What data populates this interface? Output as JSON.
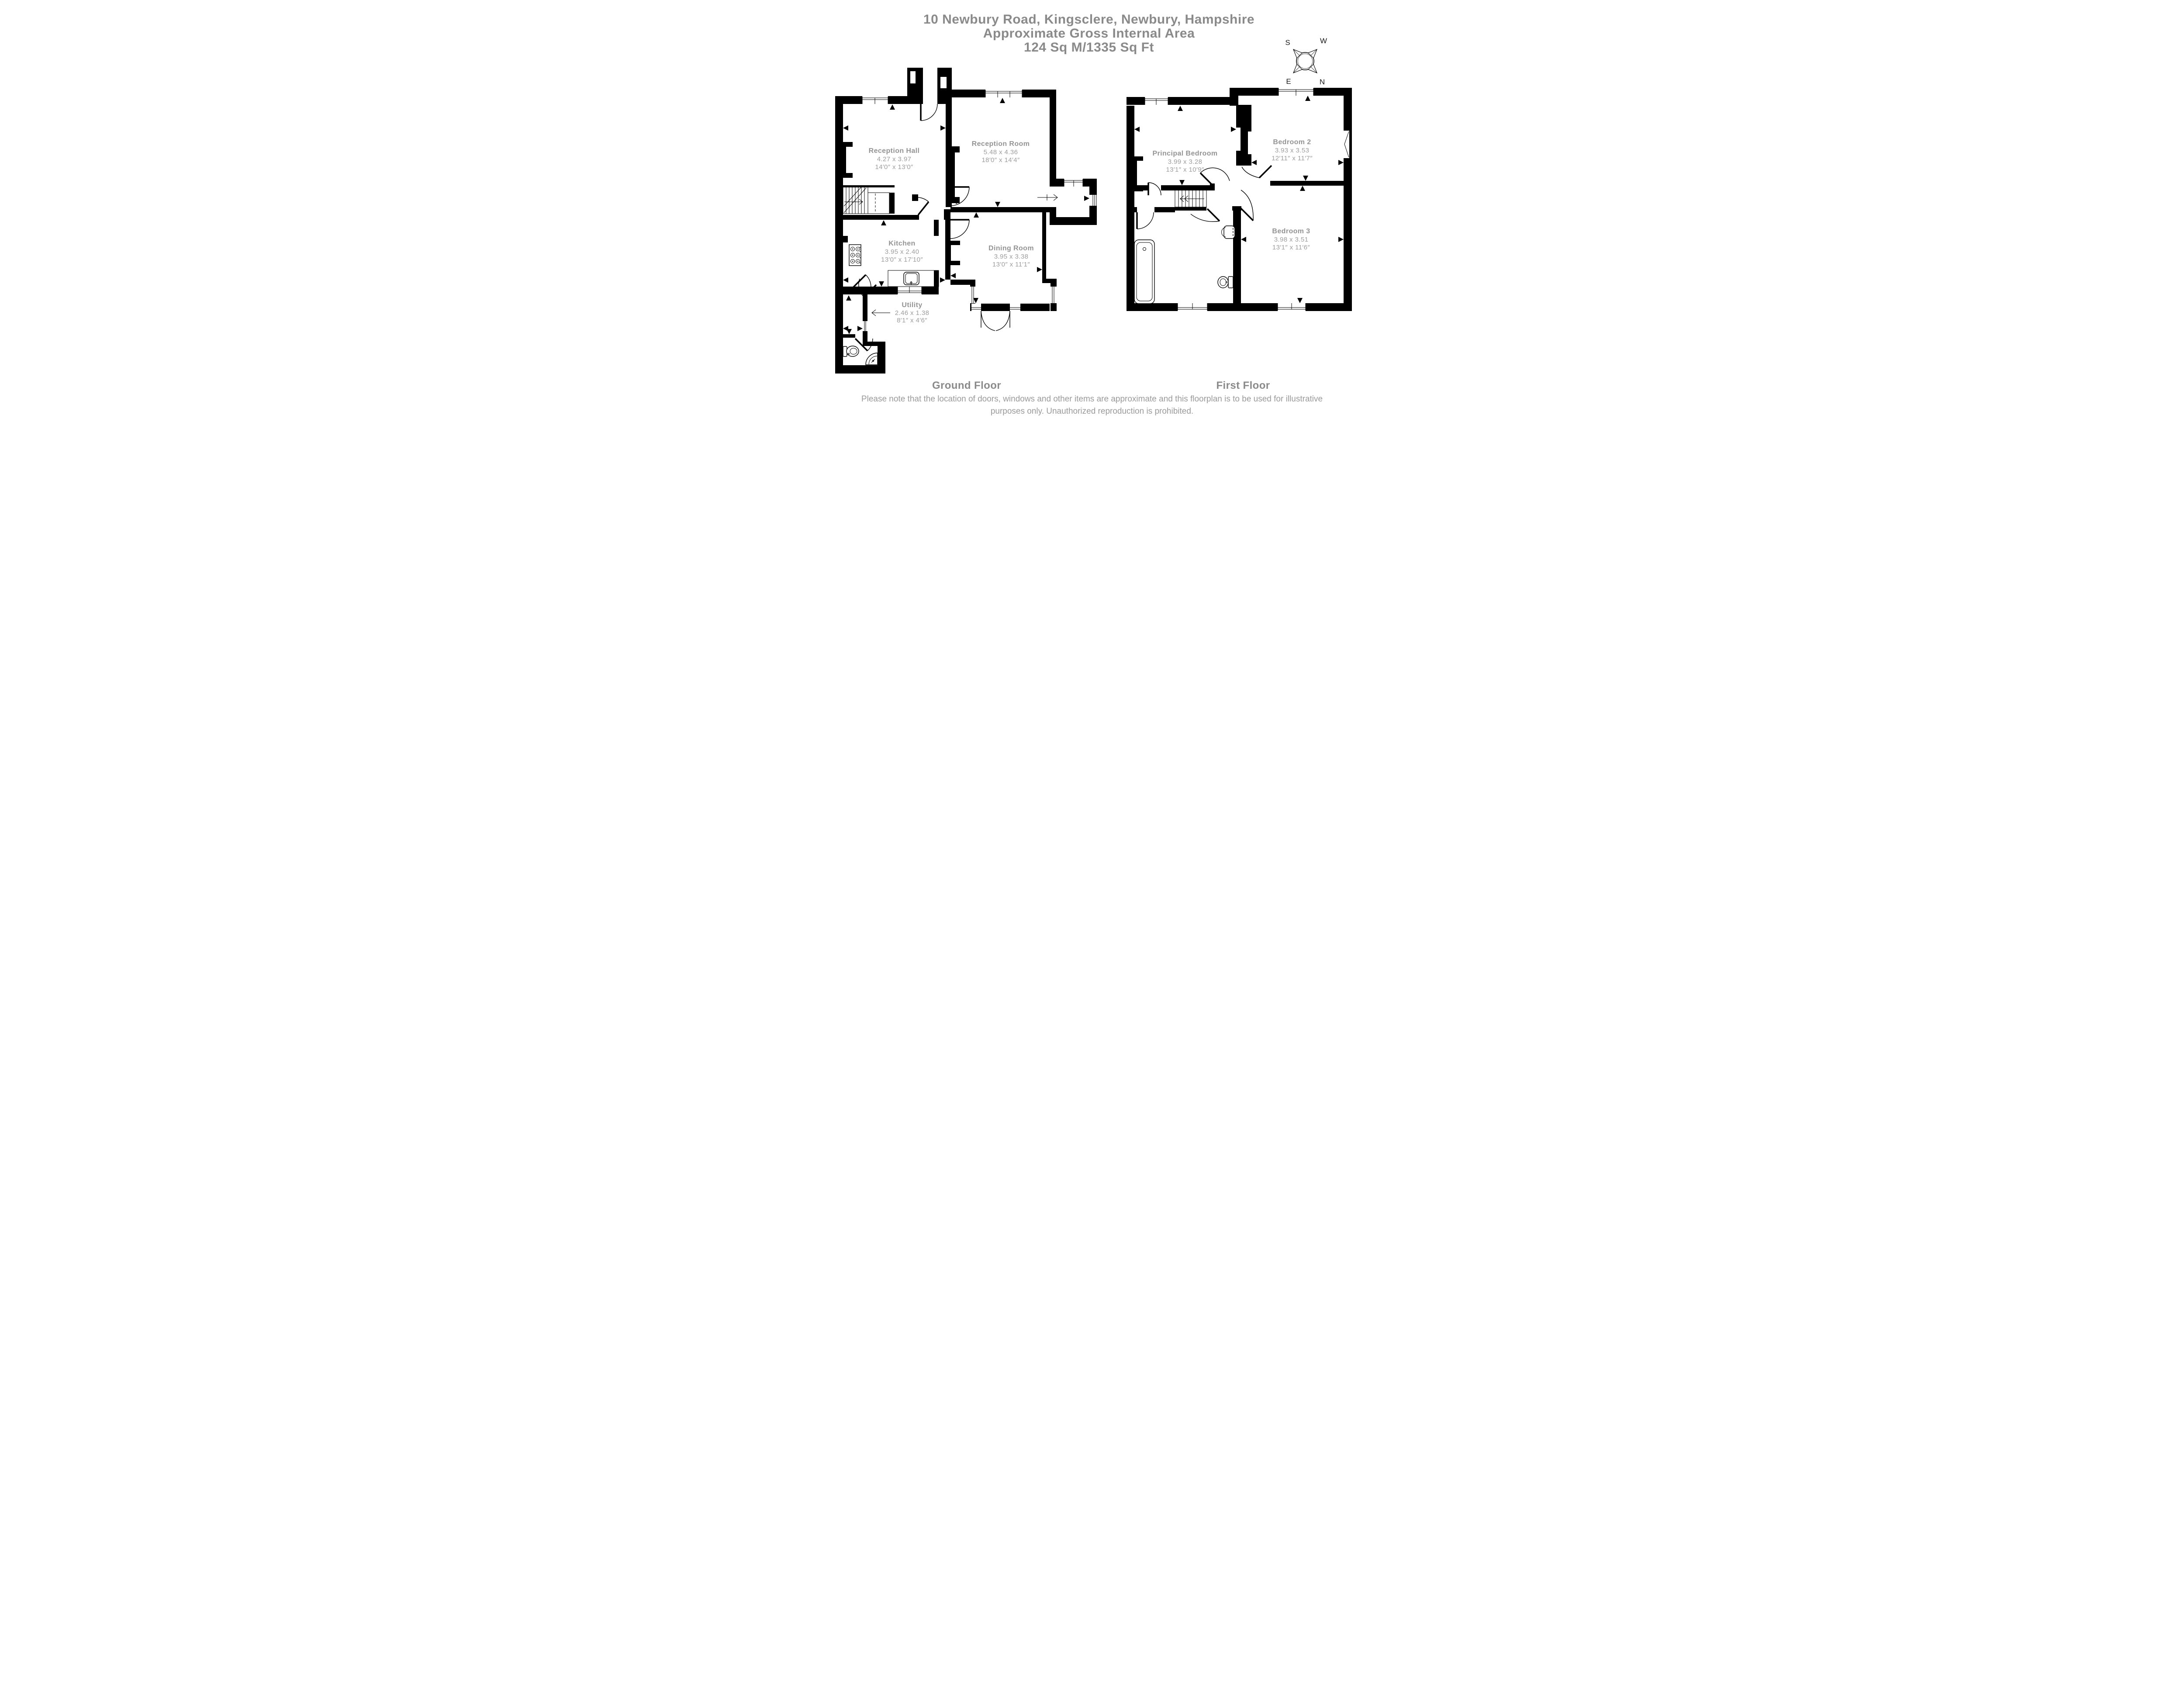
{
  "title": {
    "line1": "10 Newbury Road, Kingsclere, Newbury, Hampshire",
    "line2": "Approximate Gross Internal Area",
    "line3": "124 Sq M/1335 Sq Ft"
  },
  "compass": {
    "south": "S",
    "west": "W",
    "east": "E",
    "north": "N"
  },
  "ground_floor": {
    "label": "Ground Floor",
    "rooms": [
      {
        "name": "Reception Hall",
        "metric": "4.27 x 3.97",
        "imperial": "14′0″ x 13′0″"
      },
      {
        "name": "Reception Room",
        "metric": "5.48 x 4.36",
        "imperial": "18′0″ x 14′4″"
      },
      {
        "name": "Kitchen",
        "metric": "3.95 x 2.40",
        "imperial": "13′0″ x 17′10″"
      },
      {
        "name": "Dining Room",
        "metric": "3.95 x 3.38",
        "imperial": "13′0″ x 11′1″"
      },
      {
        "name": "Utility",
        "metric": "2.46 x 1.38",
        "imperial": "8′1″ x 4′6″"
      }
    ]
  },
  "first_floor": {
    "label": "First Floor",
    "rooms": [
      {
        "name": "Principal Bedroom",
        "metric": "3.99 x 3.28",
        "imperial": "13′1″ x 10′9″"
      },
      {
        "name": "Bedroom 2",
        "metric": "3.93 x 3.53",
        "imperial": "12′11″ x 11′7″"
      },
      {
        "name": "Bedroom 3",
        "metric": "3.98 x 3.51",
        "imperial": "13′1″ x 11′6″"
      }
    ]
  },
  "disclaimer": {
    "line1": "Please note that the location of doors, windows and other items are approximate and this floorplan is to be used for illustrative",
    "line2": "purposes only. Unauthorized reproduction is prohibited."
  },
  "colors": {
    "wall": "#000000",
    "title_text": "#8a8a8a",
    "room_text": "#9a9a9a"
  }
}
